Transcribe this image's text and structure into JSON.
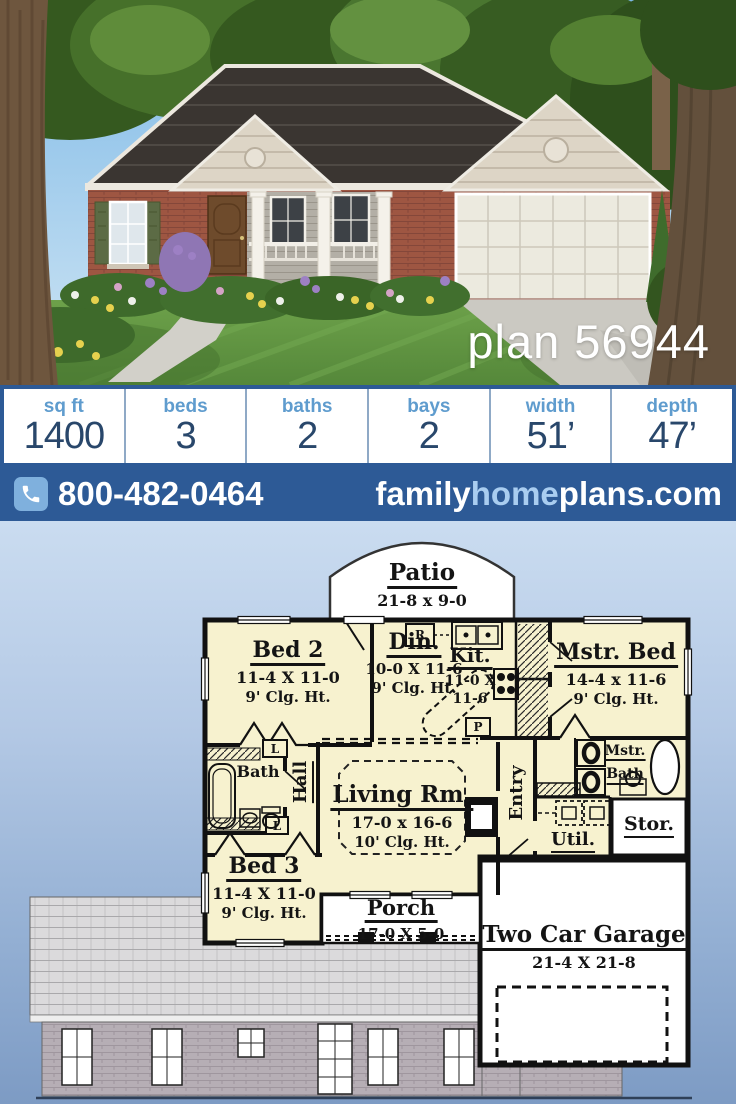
{
  "photo": {
    "plan_label": "plan 56944"
  },
  "stats": {
    "items": [
      {
        "label": "sq ft",
        "value": "1400"
      },
      {
        "label": "beds",
        "value": "3"
      },
      {
        "label": "baths",
        "value": "2"
      },
      {
        "label": "bays",
        "value": "2"
      },
      {
        "label": "width",
        "value": "51’"
      },
      {
        "label": "depth",
        "value": "47’"
      }
    ]
  },
  "contact": {
    "phone": "800-482-0464",
    "site_family": "family",
    "site_home": "home",
    "site_plans": "plans.com"
  },
  "floorplan": {
    "patio": {
      "name": "Patio",
      "dims": "21-8 x 9-0"
    },
    "bed2": {
      "name": "Bed 2",
      "dims": "11-4 X 11-0",
      "clg": "9' Clg. Ht."
    },
    "din": {
      "name": "Din.",
      "dims": "10-0 X 11-6",
      "clg": "9' Clg. Ht."
    },
    "kit": {
      "name": "Kit.",
      "dims1": "11-0 X",
      "dims2": "11-6"
    },
    "mstr_bed": {
      "name": "Mstr. Bed",
      "dims": "14-4 x 11-6",
      "clg": "9' Clg. Ht."
    },
    "bath": {
      "name": "Bath"
    },
    "hall": {
      "name": "Hall"
    },
    "living": {
      "name": "Living Rm.",
      "dims": "17-0 x 16-6",
      "clg": "10' Clg. Ht."
    },
    "entry": {
      "name": "Entry"
    },
    "mstr_bath": {
      "line1": "Mstr.",
      "line2": "Bath"
    },
    "util": {
      "name": "Util."
    },
    "stor": {
      "name": "Stor."
    },
    "bed3": {
      "name": "Bed 3",
      "dims": "11-4 X 11-0",
      "clg": "9' Clg. Ht."
    },
    "porch": {
      "name": "Porch",
      "dims": "17-0 X 5-0"
    },
    "garage": {
      "name": "Two Car Garage",
      "dims": "21-4 X 21-8"
    },
    "markers": {
      "linen": "L",
      "range": "R",
      "pantry": "P"
    }
  },
  "colors": {
    "bar_blue": "#2d5a96",
    "label_blue": "#5f9cce",
    "value_navy": "#29476b",
    "site_home_blue": "#a9cdf0",
    "room_fill": "#f7f2cf"
  }
}
